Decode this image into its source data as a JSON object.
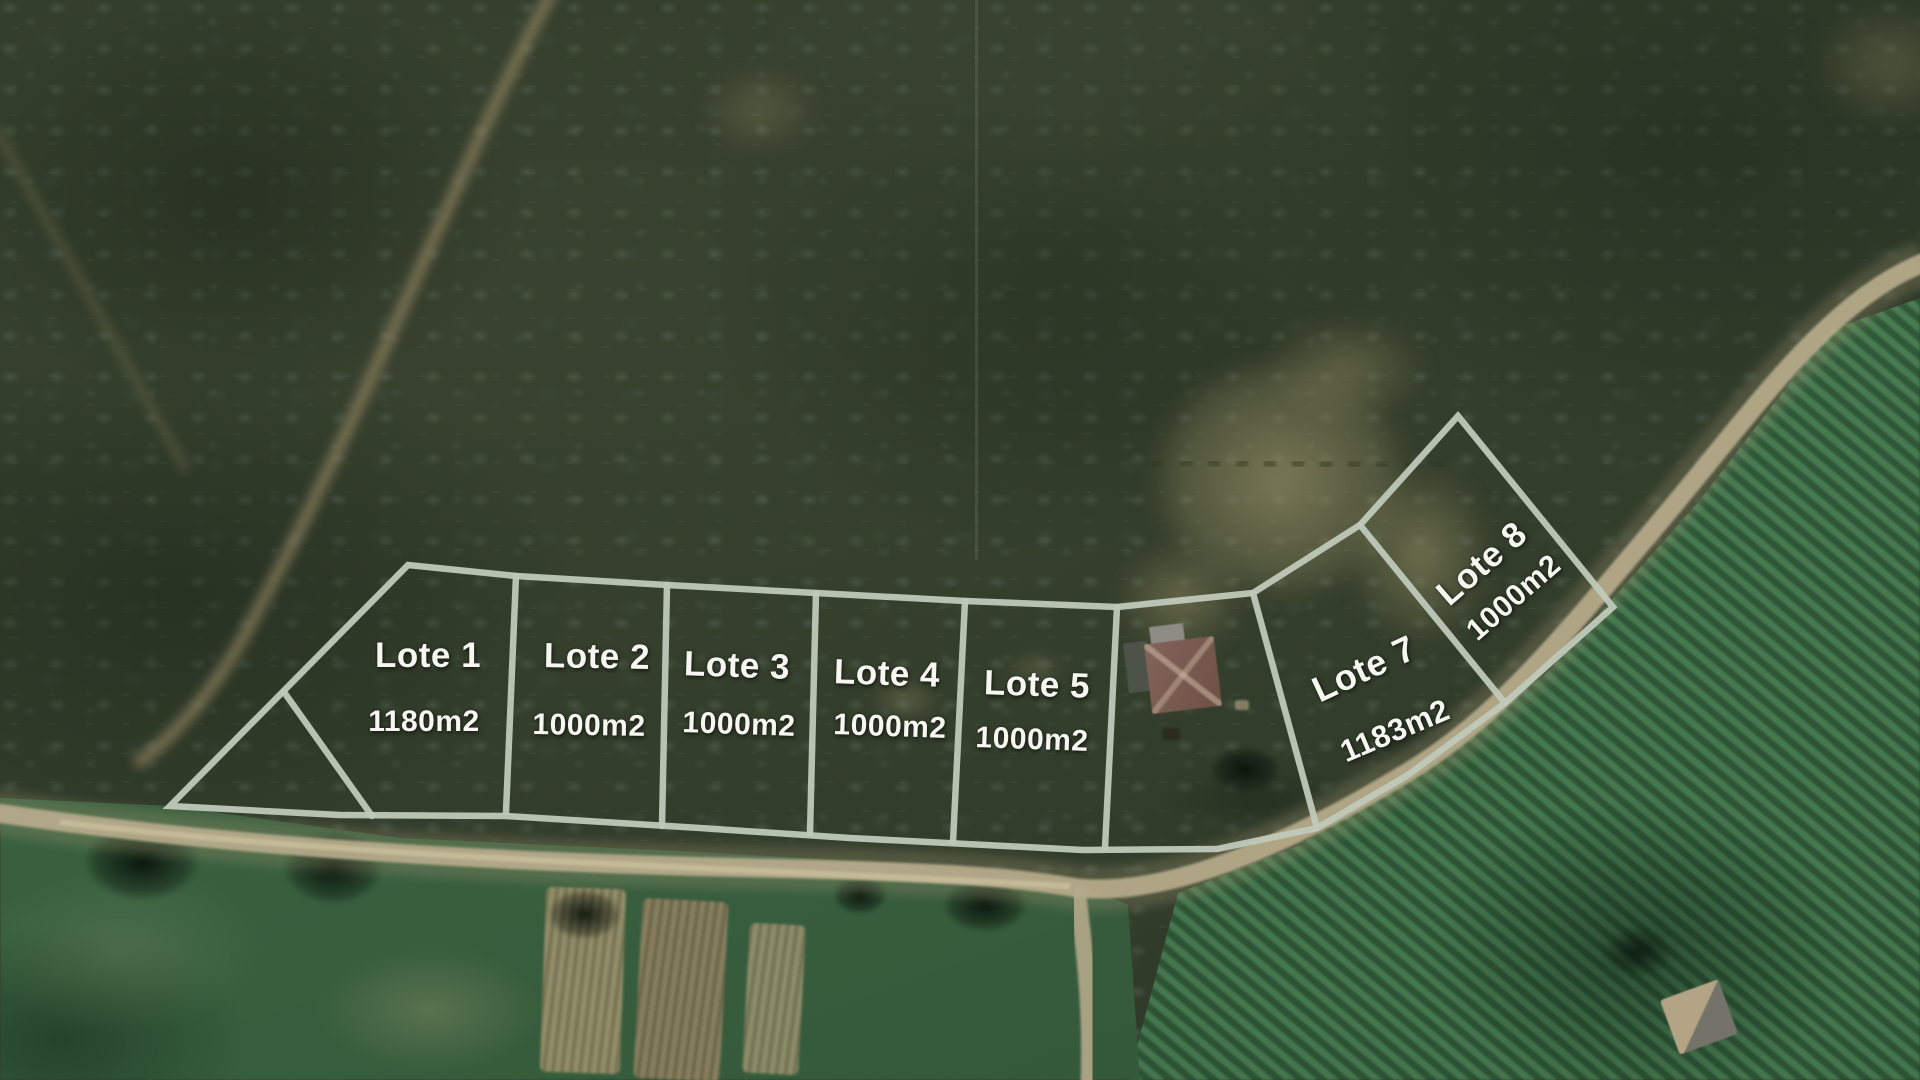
{
  "lots": [
    {
      "name": "Lote 1",
      "area": "1180m2"
    },
    {
      "name": "Lote 2",
      "area": "1000m2"
    },
    {
      "name": "Lote 3",
      "area": "1000m2"
    },
    {
      "name": "Lote 4",
      "area": "1000m2"
    },
    {
      "name": "Lote 5",
      "area": "1000m2"
    },
    {
      "name": "Lote 7",
      "area": "1183m2"
    },
    {
      "name": "Lote 8",
      "area": "1000m2"
    }
  ],
  "style": {
    "boundary_line_color": "#c0c9b9",
    "label_text_color": "#f6f7f1",
    "road_color": "#b7ac8c"
  }
}
